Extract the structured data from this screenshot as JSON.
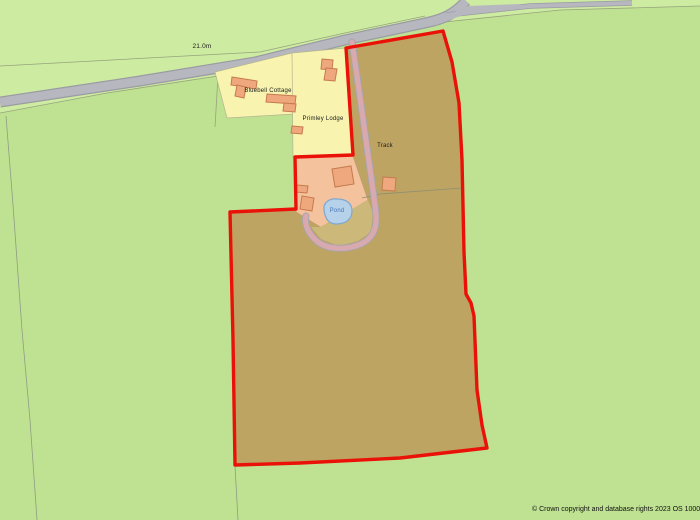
{
  "map": {
    "labels": {
      "spot_height": "21.0m",
      "bluebell_cottage": "Bluebell Cottage",
      "primley_lodge": "Primley Lodge",
      "track": "Track",
      "pond": "Pond"
    },
    "attribution": "© Crown copyright and database rights 2023 OS 1000471",
    "colors": {
      "field_green": "#bfe292",
      "light_green": "#cdeba1",
      "road_fill": "#b7b7bf",
      "road_casing": "#9b9ba3",
      "boundary_red": "#ea1208",
      "parcel_tan": "#bea462",
      "parcel_tan_light": "#ccb97a",
      "plot_yellow": "#f8f4b0",
      "plot_edge": "#b5b58c",
      "courtyard_salmon": "#f4c29c",
      "courtyard_edge": "#bd9c6e",
      "building_fill": "#efa87d",
      "building_stroke": "#c67a4e",
      "track_pink": "#d9a9b0",
      "track_casing": "#a5a5ad",
      "pond_fill": "#b6d1ea",
      "pond_stroke": "#7fa8d0",
      "pond_text": "#4a78b8",
      "faint_line": "#97a37d",
      "faint_line_gray": "#8f9d80"
    }
  }
}
